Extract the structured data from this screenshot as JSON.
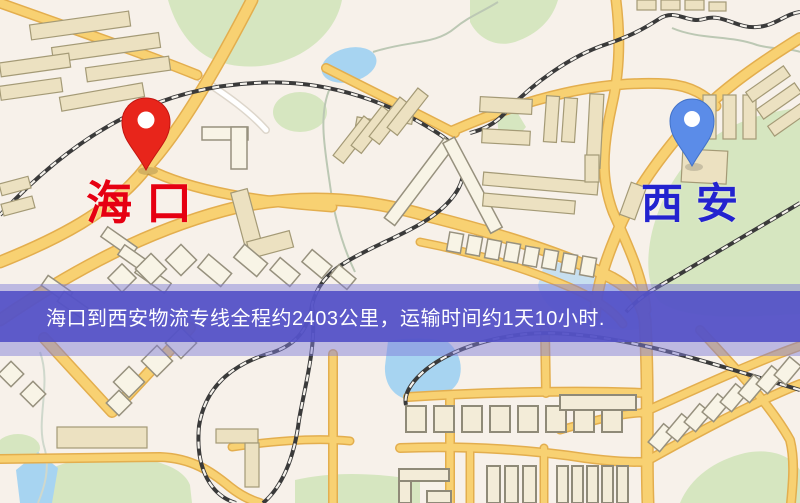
{
  "map": {
    "origin_marker": {
      "label": "海口",
      "pin_color": "#e8251b",
      "label_color": "#e60012"
    },
    "destination_marker": {
      "label": "西安",
      "pin_color": "#5b8ce8",
      "label_color": "#2323cf"
    },
    "colors": {
      "background": "#f7f1ea",
      "road_yellow": "#f8d172",
      "park_green": "#d6e6c0",
      "water_blue": "#a7d4f1",
      "railway_dark": "#3a3a3a",
      "building_tan": "#ece1c1"
    }
  },
  "banner": {
    "text": "海口到西安物流专线全程约2403公里，运输时间约1天10小时.",
    "background": "#5250c7",
    "text_color": "#ffffff"
  }
}
